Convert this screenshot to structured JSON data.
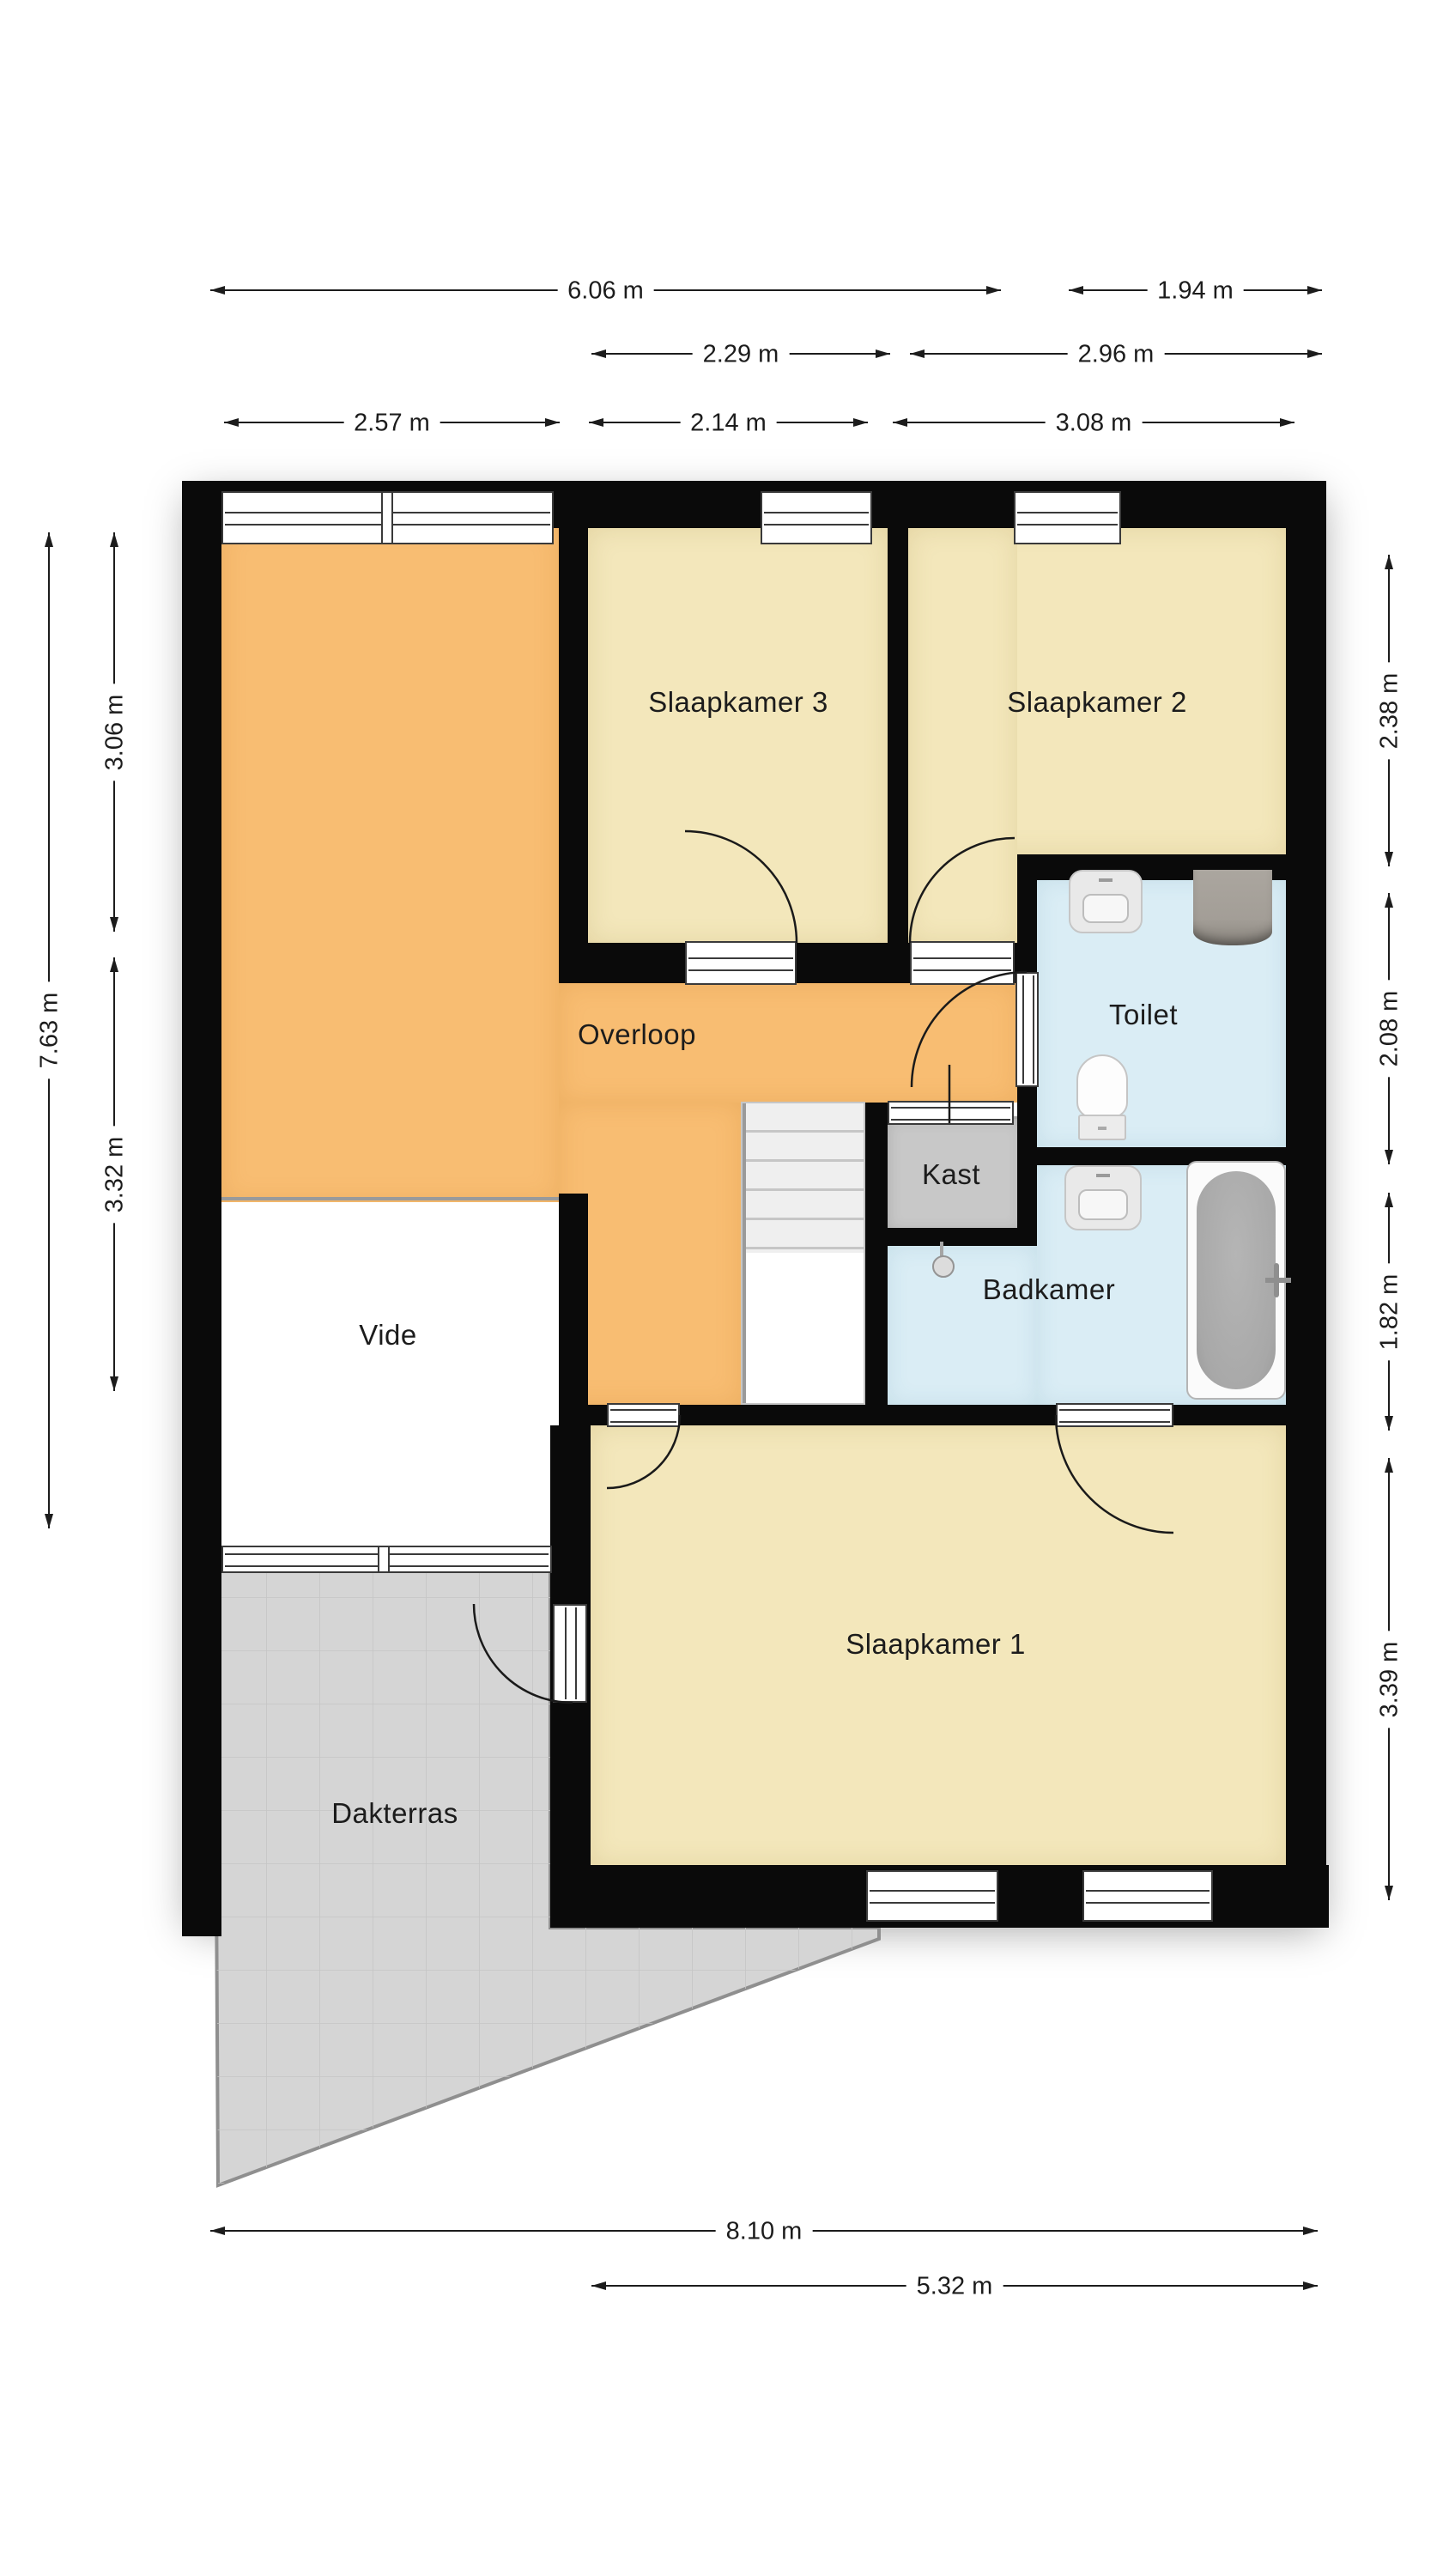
{
  "plan_type": "floorplan-first-floor",
  "rooms": {
    "slaapkamer3": "Slaapkamer 3",
    "slaapkamer2": "Slaapkamer 2",
    "toilet": "Toilet",
    "overloop": "Overloop",
    "kast": "Kast",
    "badkamer": "Badkamer",
    "vide": "Vide",
    "slaapkamer1": "Slaapkamer 1",
    "dakterras": "Dakterras"
  },
  "dims": {
    "d606": "6.06 m",
    "d194": "1.94 m",
    "d229": "2.29 m",
    "d296": "2.96 m",
    "d257": "2.57 m",
    "d214": "2.14 m",
    "d308": "3.08 m",
    "d763": "7.63 m",
    "d306": "3.06 m",
    "d332": "3.32 m",
    "d238": "2.38 m",
    "d208": "2.08 m",
    "d182": "1.82 m",
    "d339": "3.39 m",
    "d810": "8.10 m",
    "d532": "5.32 m"
  },
  "colors": {
    "wall": "#0a0a0a",
    "bedroom": "#f3e7bb",
    "hall": "#f8bd72",
    "bath": "#daedf5",
    "closet": "#c8c8c8",
    "terrace": "#d5d5d5",
    "terrace_grid": "#c5c5c5",
    "fixture": "#e9e9e9",
    "boiler": "#a6a19a",
    "tub_water": "#a8a8a8",
    "dim": "#1c1c1c",
    "label": "#1c1c1c"
  }
}
